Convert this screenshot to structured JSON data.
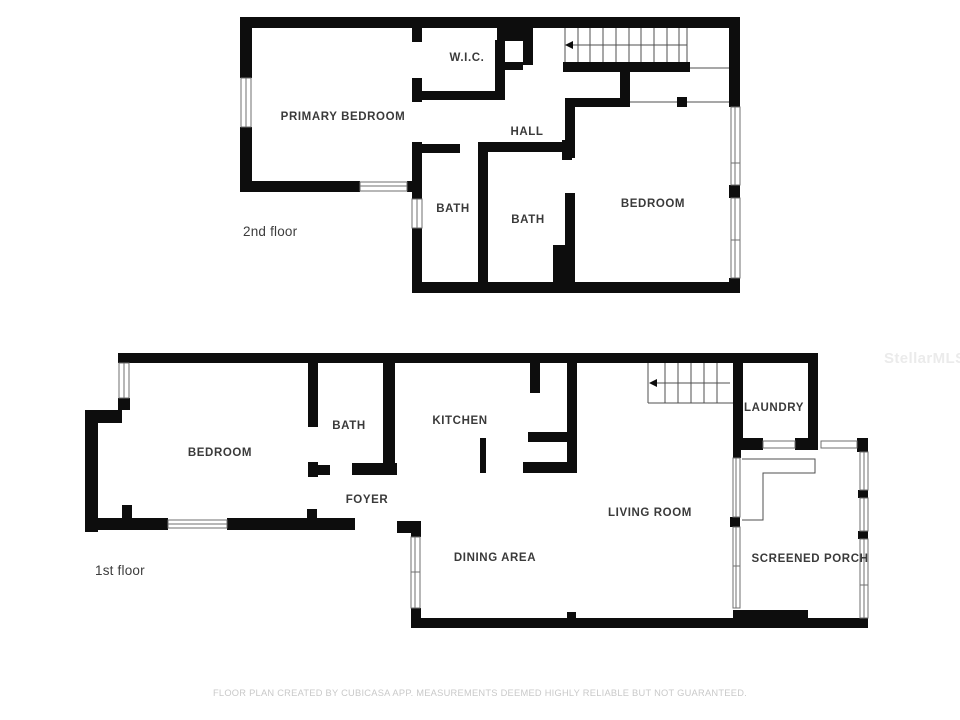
{
  "page": {
    "watermark": "StellarMLS",
    "footer": "FLOOR PLAN CREATED BY CUBICASA APP. MEASUREMENTS DEEMED HIGHLY RELIABLE BUT NOT GUARANTEED."
  },
  "floor2": {
    "label": "2nd floor",
    "rooms": {
      "primary_bedroom": "PRIMARY BEDROOM",
      "wic": "W.I.C.",
      "hall": "HALL",
      "bath_left": "BATH",
      "bath_right": "BATH",
      "bedroom": "BEDROOM"
    }
  },
  "floor1": {
    "label": "1st floor",
    "rooms": {
      "bedroom": "BEDROOM",
      "bath": "BATH",
      "kitchen": "KITCHEN",
      "foyer": "FOYER",
      "laundry": "LAUNDRY",
      "living_room": "LIVING ROOM",
      "dining_area": "DINING AREA",
      "screened_porch": "SCREENED PORCH"
    }
  },
  "colors": {
    "wall": "#0d0d0d",
    "thin_line": "#4f4f4f",
    "label": "#3a3a3a",
    "footer_text": "#c9c9c9",
    "watermark_text": "#ebebeb",
    "background": "#ffffff"
  }
}
